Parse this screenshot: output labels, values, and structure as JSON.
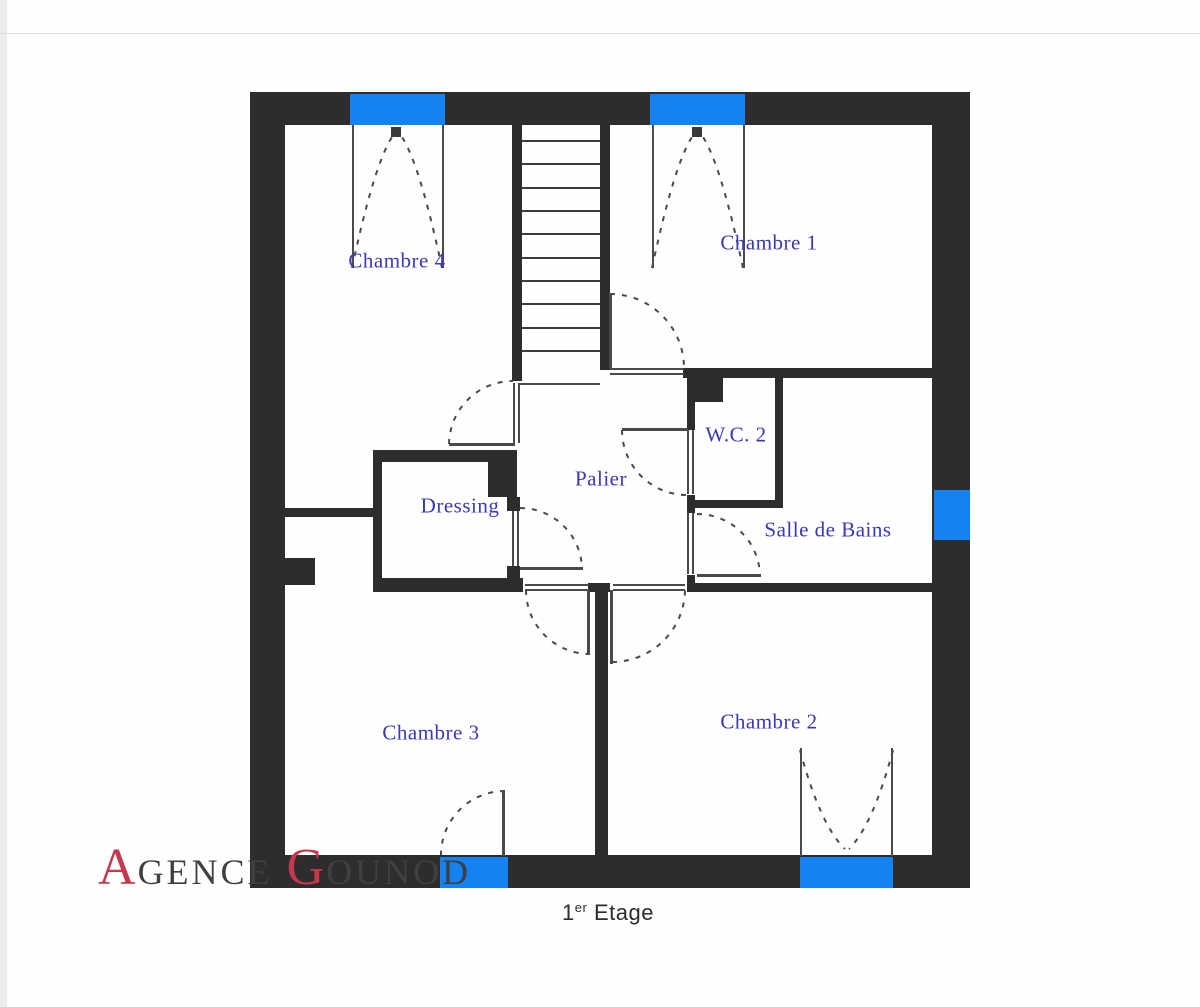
{
  "floor_label": {
    "number": "1",
    "suffix": "er",
    "word": "Etage"
  },
  "watermark": {
    "part1_initial": "A",
    "part1_rest": "GENCE",
    "part2_initial": "G",
    "part2_rest": "OUNOD",
    "initial_color": "#c5384d",
    "text_color": "#413f42"
  },
  "colors": {
    "wall": "#2e2c2e",
    "window_blue": "#1482f0",
    "room_label_blue": "#3939b8",
    "line_gray": "#4a4a4a"
  },
  "rooms": [
    {
      "id": "chambre-4",
      "label": "Chambre 4",
      "x": 397,
      "y": 261
    },
    {
      "id": "chambre-1",
      "label": "Chambre 1",
      "x": 769,
      "y": 243
    },
    {
      "id": "wc-2",
      "label": "W.C. 2",
      "x": 736,
      "y": 435
    },
    {
      "id": "palier",
      "label": "Palier",
      "x": 601,
      "y": 479
    },
    {
      "id": "dressing",
      "label": "Dressing",
      "x": 460,
      "y": 506
    },
    {
      "id": "salle-de-bains",
      "label": "Salle de Bains",
      "x": 828,
      "y": 530
    },
    {
      "id": "chambre-3",
      "label": "Chambre 3",
      "x": 431,
      "y": 733
    },
    {
      "id": "chambre-2",
      "label": "Chambre 2",
      "x": 769,
      "y": 722
    }
  ],
  "plan": {
    "walls": [
      [
        250,
        92,
        720,
        33
      ],
      [
        250,
        855,
        720,
        33
      ],
      [
        250,
        92,
        35,
        796
      ],
      [
        932,
        92,
        38,
        796
      ],
      [
        512,
        125,
        10,
        256
      ],
      [
        600,
        125,
        10,
        245
      ],
      [
        373,
        450,
        124,
        12
      ],
      [
        488,
        450,
        29,
        47
      ],
      [
        507,
        497,
        13,
        14
      ],
      [
        507,
        566,
        13,
        18
      ],
      [
        373,
        452,
        9,
        138
      ],
      [
        373,
        578,
        150,
        14
      ],
      [
        588,
        583,
        22,
        9
      ],
      [
        687,
        583,
        245,
        9
      ],
      [
        595,
        583,
        13,
        272
      ],
      [
        683,
        368,
        252,
        10
      ],
      [
        687,
        375,
        36,
        27
      ],
      [
        687,
        400,
        8,
        30
      ],
      [
        687,
        495,
        8,
        18
      ],
      [
        687,
        575,
        8,
        10
      ],
      [
        687,
        500,
        96,
        8
      ],
      [
        775,
        375,
        8,
        133
      ],
      [
        285,
        508,
        88,
        9
      ],
      [
        285,
        558,
        30,
        27
      ]
    ],
    "windows": [
      [
        350,
        94,
        95,
        31
      ],
      [
        650,
        94,
        95,
        31
      ],
      [
        934,
        490,
        36,
        50
      ],
      [
        440,
        857,
        68,
        31
      ],
      [
        800,
        857,
        93,
        31
      ]
    ],
    "lines": [
      [
        352,
        125,
        2,
        143
      ],
      [
        442,
        125,
        2,
        143
      ],
      [
        652,
        125,
        2,
        143
      ],
      [
        743,
        125,
        2,
        143
      ],
      [
        609,
        293,
        3,
        76
      ],
      [
        610,
        368,
        74,
        2
      ],
      [
        610,
        373,
        74,
        2
      ],
      [
        449,
        443,
        66,
        3
      ],
      [
        513,
        383,
        2,
        60
      ],
      [
        518,
        383,
        2,
        60
      ],
      [
        622,
        428,
        66,
        3
      ],
      [
        687,
        430,
        2,
        64
      ],
      [
        692,
        430,
        2,
        64
      ],
      [
        697,
        574,
        64,
        3
      ],
      [
        687,
        513,
        2,
        61
      ],
      [
        692,
        513,
        2,
        61
      ],
      [
        520,
        567,
        63,
        3
      ],
      [
        512,
        511,
        2,
        55
      ],
      [
        517,
        511,
        2,
        55
      ],
      [
        587,
        590,
        3,
        65
      ],
      [
        525,
        584,
        64,
        2
      ],
      [
        525,
        589,
        64,
        2
      ],
      [
        610,
        590,
        3,
        74
      ],
      [
        613,
        584,
        72,
        2
      ],
      [
        613,
        589,
        72,
        2
      ],
      [
        502,
        790,
        3,
        66
      ],
      [
        800,
        748,
        2,
        108
      ],
      [
        891,
        748,
        2,
        108
      ],
      [
        520,
        383,
        80,
        2
      ]
    ],
    "stiles": [
      [
        391,
        127,
        10,
        10
      ],
      [
        692,
        127,
        10,
        10
      ]
    ],
    "stairs": {
      "x": 522,
      "width": 78,
      "first_y": 140,
      "last_y": 350,
      "count": 10
    },
    "arcs": [
      {
        "name": "window-casement-arc",
        "d": "M 352 268 Q 374 165 392 137"
      },
      {
        "name": "window-casement-arc",
        "d": "M 442 268 Q 420 165 402 137"
      },
      {
        "name": "window-casement-arc",
        "d": "M 652 268 Q 674 165 692 137"
      },
      {
        "name": "window-casement-arc",
        "d": "M 743 268 Q 721 165 703 137"
      },
      {
        "name": "door-swing-arc-chambre-1",
        "d": "M 610 294 A 74 74 0 0 1 684 368"
      },
      {
        "name": "door-swing-arc-chambre-4",
        "d": "M 449 444 A 64 64 0 0 1 513 381"
      },
      {
        "name": "door-swing-arc-wc-2",
        "d": "M 622 430 A 65 65 0 0 0 687 495"
      },
      {
        "name": "door-swing-arc-salle-de-bains",
        "d": "M 697 514 A 63 63 0 0 1 760 577"
      },
      {
        "name": "door-swing-arc-dressing",
        "d": "M 520 508 A 62 62 0 0 1 582 570"
      },
      {
        "name": "door-swing-arc-chambre-3",
        "d": "M 526 590 A 64 64 0 0 0 590 654"
      },
      {
        "name": "door-swing-arc-chambre-2",
        "d": "M 612 662 A 73 73 0 0 0 685 590"
      },
      {
        "name": "door-swing-arc-porte-fenetre",
        "d": "M 505 791 A 64 64 0 0 0 441 855"
      },
      {
        "name": "window-casement-arc",
        "d": "M 800 750 Q 820 825 845 849"
      },
      {
        "name": "window-casement-arc",
        "d": "M 893 750 Q 873 825 849 849"
      }
    ]
  }
}
